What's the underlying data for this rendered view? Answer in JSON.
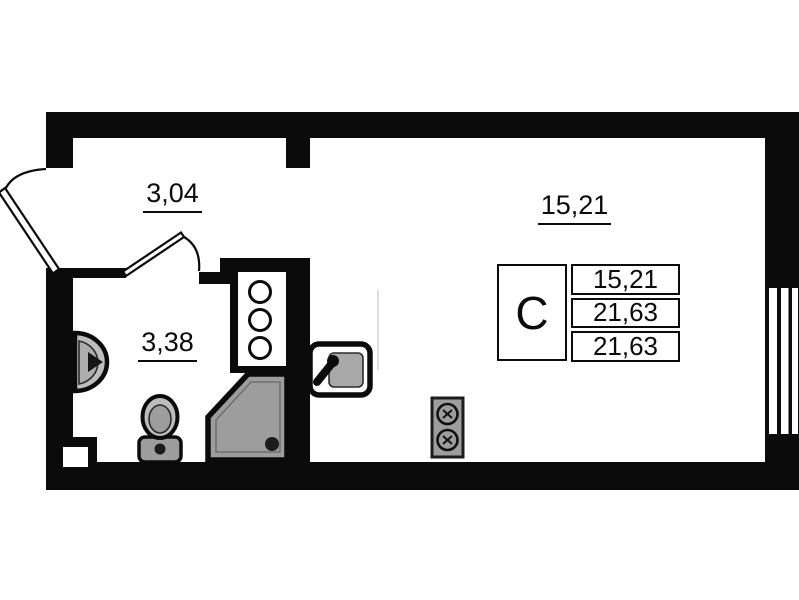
{
  "title": "Studio apartment floor plan",
  "rooms": {
    "hallway": {
      "area": "3,04"
    },
    "bathroom": {
      "area": "3,38"
    },
    "living": {
      "area": "15,21"
    }
  },
  "legend": {
    "type_letter": "С",
    "rows": [
      "15,21",
      "21,63",
      "21,63"
    ]
  },
  "fixtures": {
    "entry_door": "door-swing",
    "bathroom_door": "door-swing",
    "window": "triple-pane-window",
    "riser_shaft": "three-pipe-circles",
    "shower": "corner-shower-cabin",
    "toilet": "toilet",
    "washbasin": "wall-washbasin",
    "kitchen_sink": "sink-with-faucet",
    "stove": "two-burner-stove"
  },
  "colors": {
    "wall": "#0b0b0b",
    "background": "#ffffff",
    "fixture_gray": "#9d9d9d",
    "fixture_light_gray": "#bdbdbd",
    "fixture_dark": "#1c1c1c"
  }
}
